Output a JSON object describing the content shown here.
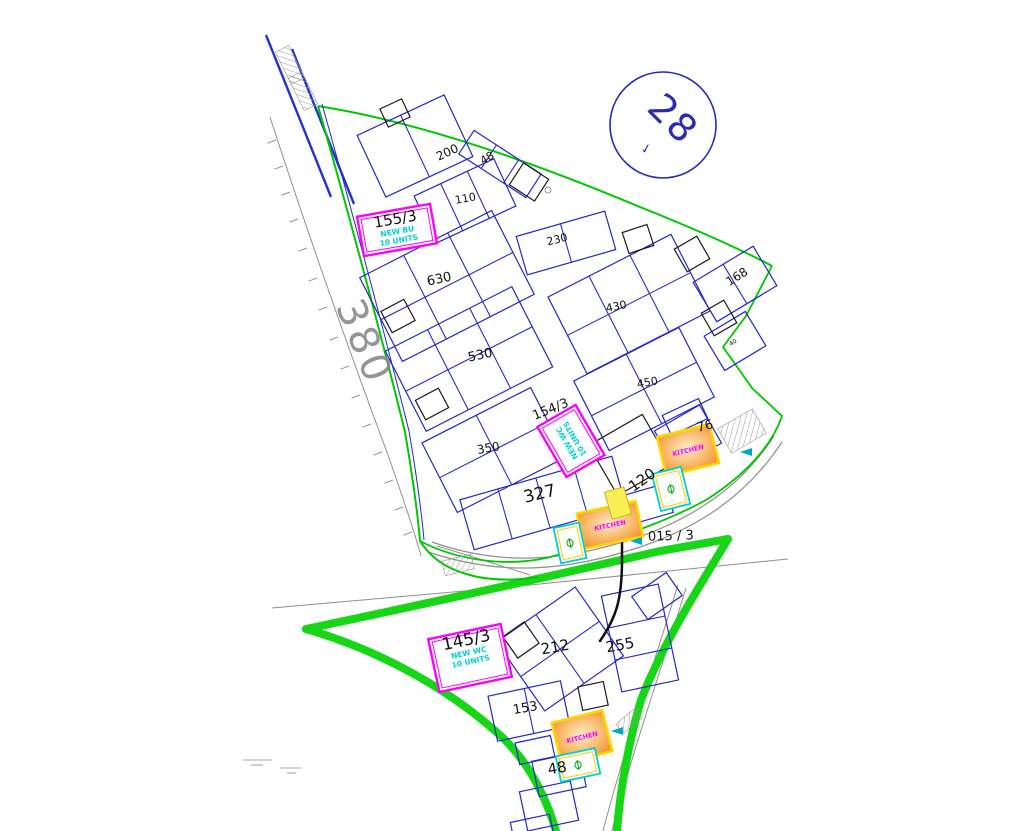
{
  "canvas": {
    "width": 1024,
    "height": 831,
    "background": "#ffffff"
  },
  "colors": {
    "parcel_blue": "#2626c9",
    "black_parcel": "#1a1a1a",
    "boundary_green": "#00c800",
    "road_green_thick": "#16d616",
    "magenta": "#ff00ff",
    "cyan_text": "#00d2d2",
    "cyan_border": "#00cfcf",
    "kitchen_orange": "#ef8c1e",
    "kitchen_border_yellow": "#ffd400",
    "yellow_block": "#f8ef55",
    "road_gray": "#909090",
    "stamp_blue": "#2a2ab8",
    "street_gray": "#8a8a8a",
    "marker_cyan": "#00a8c8"
  },
  "stamp": {
    "number": "28",
    "mark": "✓"
  },
  "street_label": {
    "text": "380"
  },
  "note": {
    "text": "015 / 3"
  },
  "kitchen_label": "KITCHEN",
  "special_units": [
    {
      "name": "unit-155-3",
      "plot_no": "155/3",
      "line1": "NEW BU",
      "line2": "10 UNITS"
    },
    {
      "name": "unit-154-3",
      "plot_no": "154/3",
      "line1": "NEW WC",
      "line2": "10 UNITS"
    },
    {
      "name": "unit-145-3",
      "plot_no": "145/3",
      "line1": "NEW WC",
      "line2": "10 UNITS"
    }
  ],
  "plot_labels": [
    {
      "name": "plot-label-200",
      "text": "200",
      "x": 449,
      "y": 156,
      "rot": -25,
      "size": 12
    },
    {
      "name": "plot-label-48-upper",
      "text": "48",
      "x": 489,
      "y": 161,
      "rot": -32,
      "size": 11
    },
    {
      "name": "plot-label-110",
      "text": "110",
      "x": 466,
      "y": 202,
      "rot": -10,
      "size": 11
    },
    {
      "name": "plot-label-230",
      "text": "230",
      "x": 558,
      "y": 243,
      "rot": -14,
      "size": 11
    },
    {
      "name": "plot-label-630",
      "text": "630",
      "x": 440,
      "y": 283,
      "rot": -12,
      "size": 13
    },
    {
      "name": "plot-label-430",
      "text": "430",
      "x": 617,
      "y": 310,
      "rot": -12,
      "size": 11
    },
    {
      "name": "plot-label-530",
      "text": "530",
      "x": 481,
      "y": 359,
      "rot": -12,
      "size": 13
    },
    {
      "name": "plot-label-450",
      "text": "450",
      "x": 648,
      "y": 386,
      "rot": -10,
      "size": 11
    },
    {
      "name": "plot-label-350",
      "text": "350",
      "x": 489,
      "y": 452,
      "rot": -10,
      "size": 12
    },
    {
      "name": "plot-label-327",
      "text": "327",
      "x": 541,
      "y": 499,
      "rot": -14,
      "size": 17
    },
    {
      "name": "plot-label-120",
      "text": "120",
      "x": 645,
      "y": 484,
      "rot": -35,
      "size": 15
    },
    {
      "name": "plot-label-76",
      "text": "76",
      "x": 706,
      "y": 430,
      "rot": -15,
      "size": 13
    },
    {
      "name": "plot-label-168",
      "text": "168",
      "x": 739,
      "y": 280,
      "rot": -32,
      "size": 12
    },
    {
      "name": "plot-label-40",
      "text": "40",
      "x": 734,
      "y": 344,
      "rot": -32,
      "size": 6
    },
    {
      "name": "plot-label-212",
      "text": "212",
      "x": 556,
      "y": 652,
      "rot": -10,
      "size": 15
    },
    {
      "name": "plot-label-255",
      "text": "255",
      "x": 621,
      "y": 650,
      "rot": -10,
      "size": 15
    },
    {
      "name": "plot-label-153",
      "text": "153",
      "x": 526,
      "y": 712,
      "rot": -10,
      "size": 13
    },
    {
      "name": "plot-label-48-lower",
      "text": "48",
      "x": 558,
      "y": 773,
      "rot": -10,
      "size": 15
    }
  ]
}
